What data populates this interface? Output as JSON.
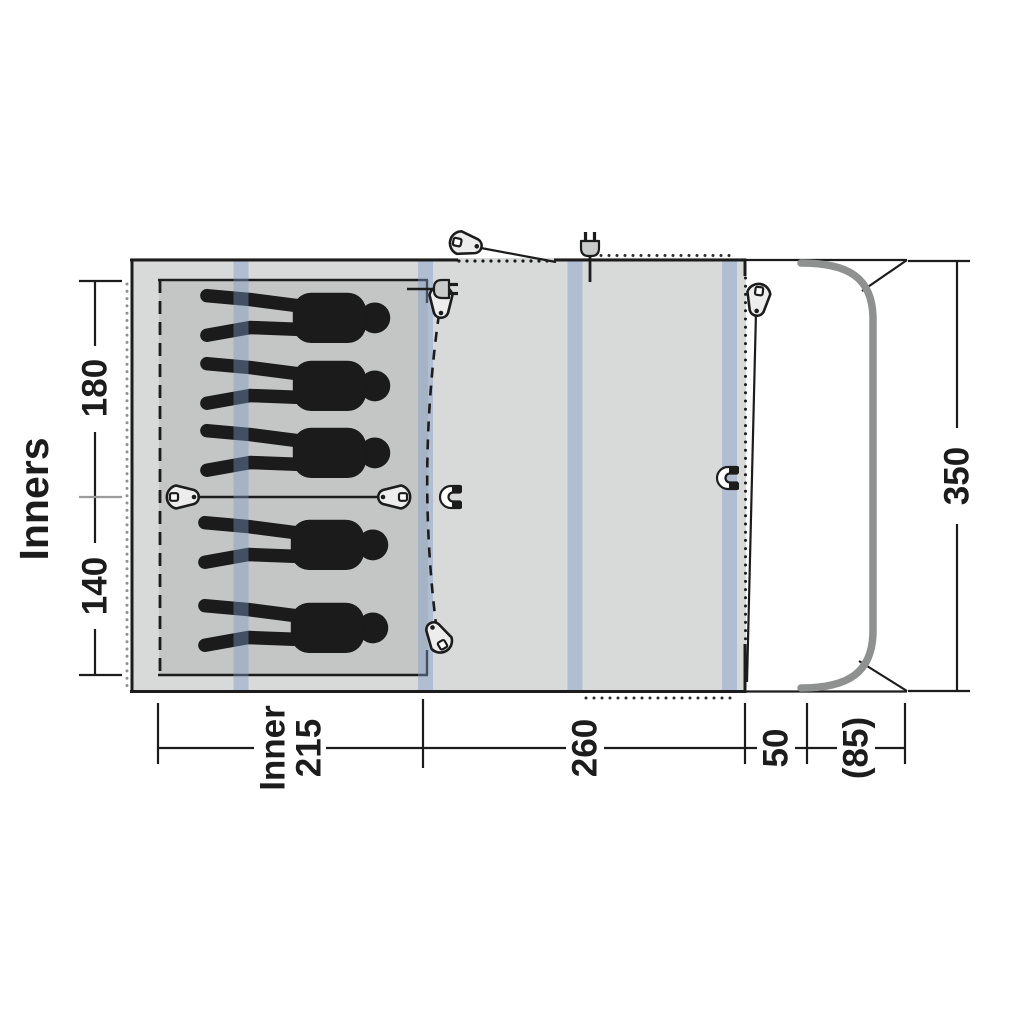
{
  "diagram": {
    "type": "tent-floorplan-top-view",
    "labels": {
      "inners_title": "Inners",
      "inner_section_top_depth": "180",
      "inner_section_bottom_depth": "140",
      "total_depth": "350",
      "inner_width_word": "Inner",
      "inner_width_value": "215",
      "living_area_width": "260",
      "front_section_width": "50",
      "canopy_depth": "(85)"
    },
    "figures": {
      "count": 5,
      "meaning": "sleeping-person-silhouette"
    },
    "colors": {
      "tent_fill": "#d8dad9",
      "inner_fill": "#c4c6c5",
      "pole_band": "#7d98c6",
      "outline": "#1c1c1c",
      "canopy_pole": "#8f9191"
    }
  }
}
